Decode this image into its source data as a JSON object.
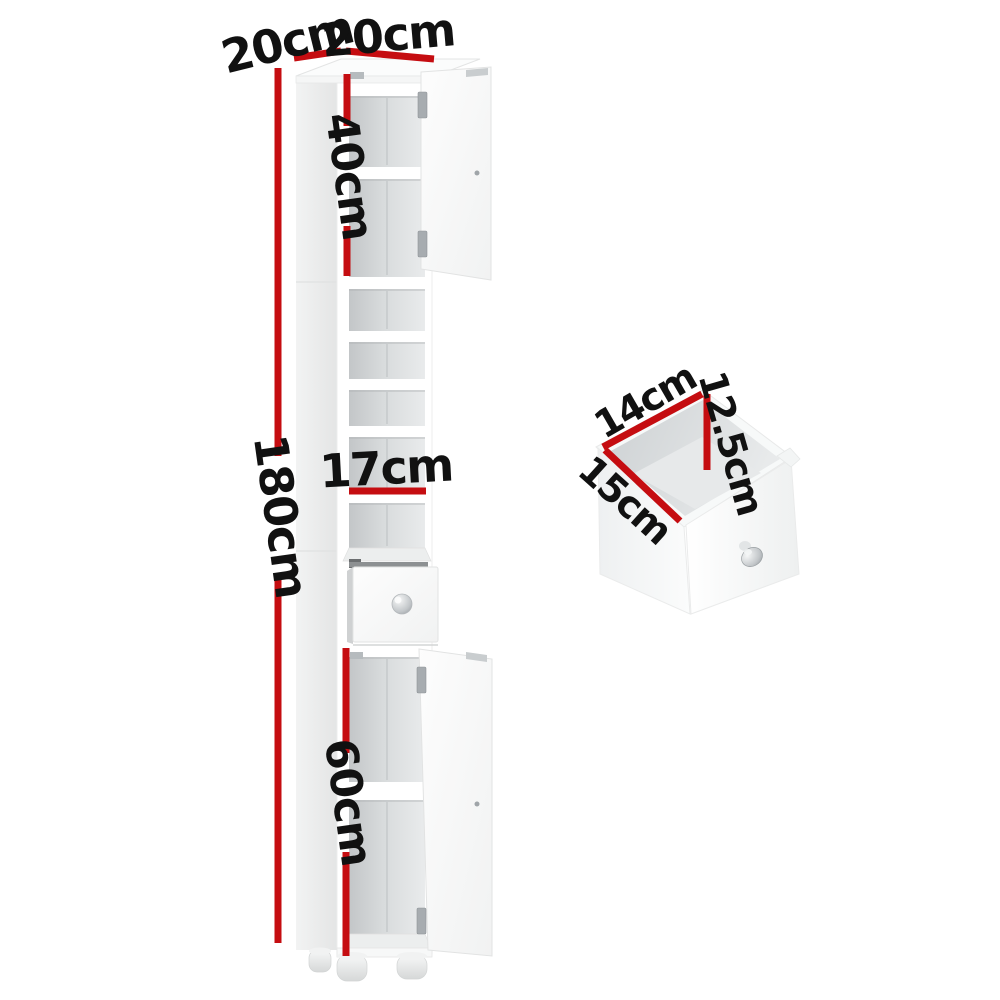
{
  "canvas": {
    "background": "#ffffff"
  },
  "colors": {
    "dimension_line": "#c50d11",
    "label_text": "#111111",
    "cabinet_body": "#ffffff",
    "interior_shade": "#d6d9da"
  },
  "cabinet": {
    "description": "tall-slim-bathroom-storage-cabinet",
    "dimensions": {
      "top_depth": "20cm",
      "top_width": "20cm",
      "upper_section_height": "40cm",
      "total_height": "180cm",
      "shelf_width": "17cm",
      "lower_section_height": "60cm"
    }
  },
  "drawer_detail": {
    "description": "pull-out-drawer-inner-dimensions",
    "dimensions": {
      "width": "14cm",
      "height": "12.5cm",
      "depth": "15cm"
    }
  }
}
